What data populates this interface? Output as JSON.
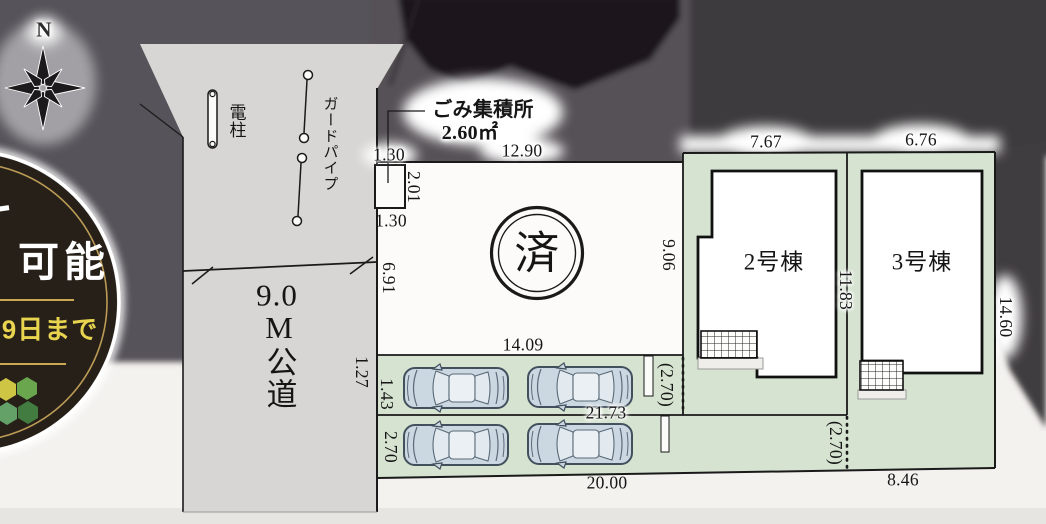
{
  "plan": {
    "compass_north": "N",
    "sold_badge": "済",
    "buildings": [
      {
        "label": "2号棟"
      },
      {
        "label": "3号棟"
      }
    ],
    "road_label": {
      "line1": "9.0",
      "line2": "M公道"
    },
    "garbage_station": {
      "title": "ごみ集積所",
      "area": "2.60㎡"
    },
    "utility_pole_label": "電柱",
    "guard_pipe_label": "ガードパイプ",
    "dimensions": {
      "garbage_top": "1.30",
      "garbage_side": "2.01",
      "garbage_bottom": "1.30",
      "frontage_upper": "6.91",
      "frontage_lower": "1.27",
      "lot1_top": "12.90",
      "parking_top": "14.09",
      "parking_row1_width": "1.43",
      "parking_row2_width": "2.70",
      "parking_mid": "21.73",
      "parking_bottom": "20.00",
      "setback_inner": "(2.70)",
      "setback_outer": "(2.70)",
      "lot3_bottom": "8.46",
      "lot2_left": "9.06",
      "lot2_top": "7.67",
      "lot3_top": "6.76",
      "lot_divider": "11.83",
      "lot3_right": "14.60"
    },
    "colors": {
      "lot_green": "#d5e3d0",
      "road_gray": "#d8d6d4",
      "photo_dark": "#57535a",
      "badge_gold": "#c8a850",
      "badge_yellow": "#e9d44f"
    }
  },
  "promo_badge": {
    "text_main": "可能",
    "text_sub": "9日まで"
  }
}
